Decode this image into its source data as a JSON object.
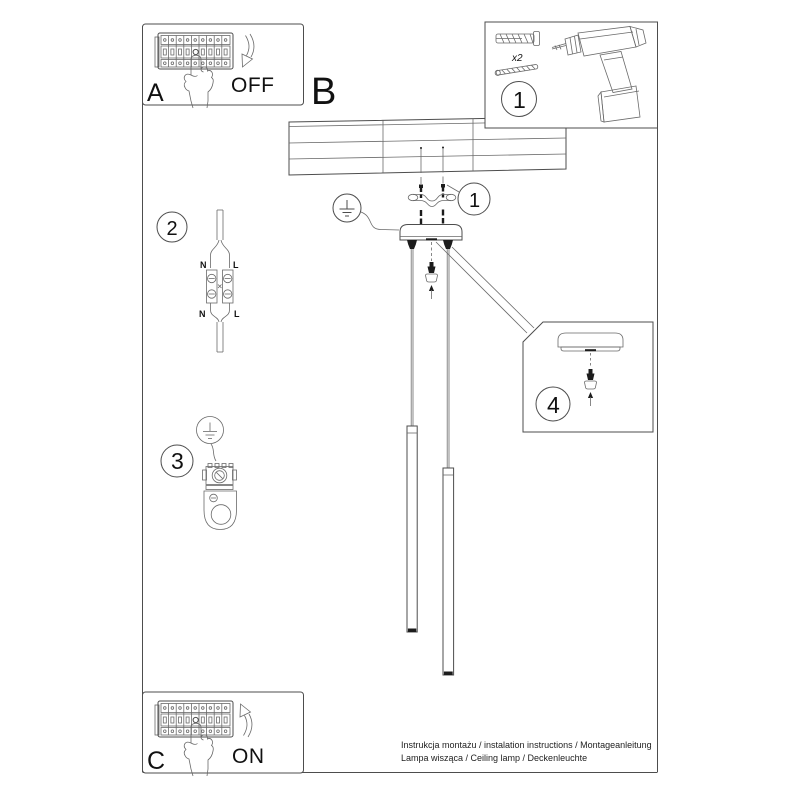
{
  "boxA": {
    "label": "A",
    "state": "OFF"
  },
  "stepB": {
    "label": "B"
  },
  "boxC": {
    "label": "C",
    "state": "ON"
  },
  "parts": {
    "number": "1",
    "anchor_qty": "x2"
  },
  "callout_screws": {
    "number": "1"
  },
  "step2": {
    "number": "2",
    "n_top": "N",
    "l_top": "L",
    "n_bottom": "N",
    "l_bottom": "L"
  },
  "step3": {
    "number": "3"
  },
  "step4": {
    "number": "4"
  },
  "footer": {
    "line1": "Instrukcja montażu / instalation instructions / Montageanleitung",
    "line2": "Lampa wisząca / Ceiling lamp / Deckenleuchte"
  },
  "colors": {
    "line": "#4d4d4d",
    "ink": "#111111",
    "dark_parts": "#1c1c1c",
    "background": "#ffffff"
  }
}
